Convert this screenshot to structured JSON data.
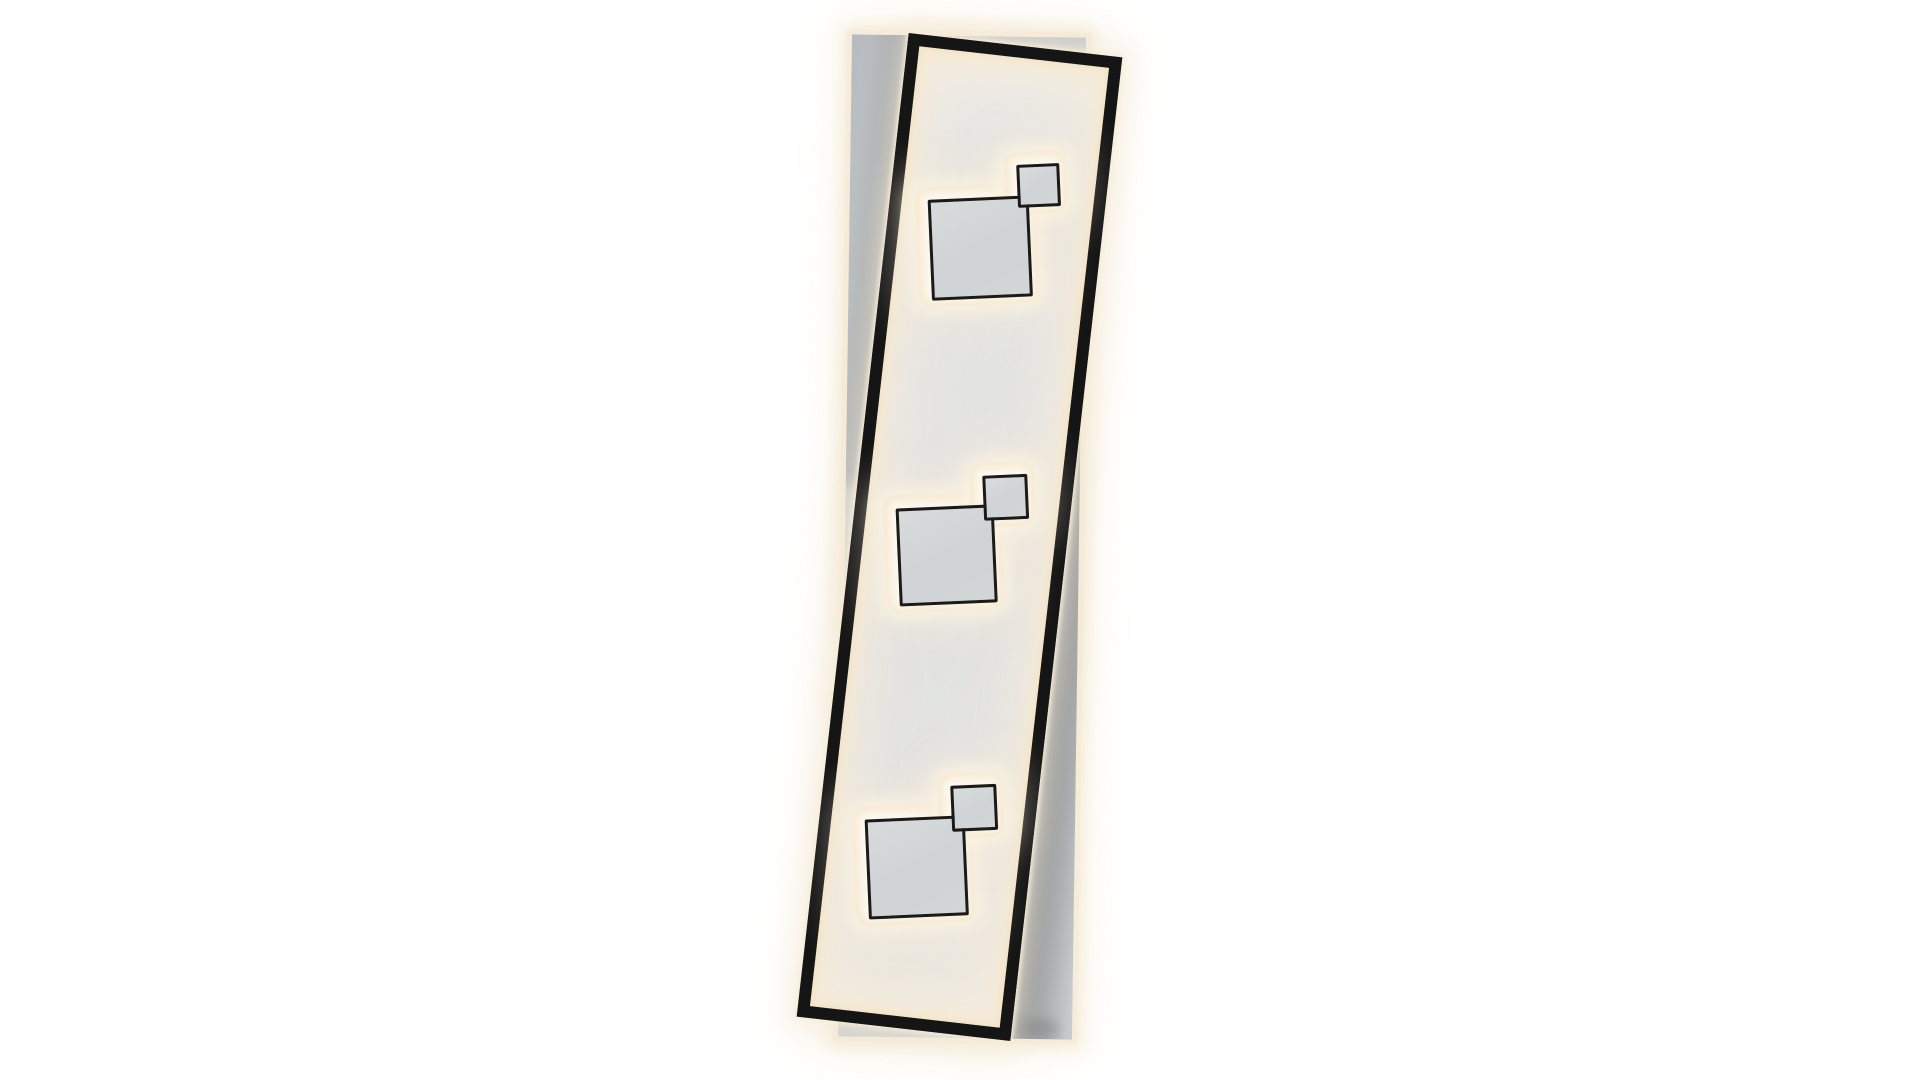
{
  "scene": {
    "description": "Product photo of a rectangular LED ceiling light: a slim black metal frame, tilted clockwise, with warm-white backlit interior, mounted over a straight gray back panel; three pairs of overlapping gray squares (one large, one small) with thin black outlines glow with warm halos along the frame's vertical axis.",
    "background_label": "white studio wall",
    "colors": {
      "wall": "#ffffff",
      "frame_black": "#151515",
      "border_black": "#1a1a1a",
      "panel_gray": "#e2e3e2",
      "gray_dark": "#b7bcc1",
      "gray_mid": "#c3c8cb",
      "gray_light": "#c9cdd0",
      "halo_white": "#fdf8ee",
      "glow_strong": "#f3e3c6",
      "glow_soft": "#f6e9cf",
      "rim_cream": "#f6ecd9",
      "shadow_dark": "rgba(44,49,54,0.55)"
    },
    "back_panel": {
      "left": 845,
      "top": 36,
      "width": 234,
      "height": 1002,
      "rotation_deg": 0.8
    },
    "back_panel_shadows": [
      {
        "name": "right-of-frame",
        "left": 200,
        "top": 378,
        "width": 92,
        "height": 660,
        "rotation_deg": 5.7
      },
      {
        "name": "left-of-frame",
        "left": -20,
        "top": -40,
        "width": 62,
        "height": 490,
        "rotation_deg": 5.7
      },
      {
        "name": "below-frame",
        "left": -45,
        "top": 972,
        "width": 265,
        "height": 34,
        "rotation_deg": 5.7
      }
    ],
    "frame": {
      "left": 852,
      "top": 42,
      "width": 215,
      "height": 990,
      "border_px": 12,
      "rotation_deg": 6.5
    },
    "square_groups": [
      {
        "name": "top",
        "left": 908,
        "top": 145,
        "width": 170,
        "height": 170,
        "rotation_deg": -2.5,
        "halo_big": {
          "left": 10,
          "top": 41,
          "size": 117
        },
        "halo_small": {
          "left": 100,
          "top": 10,
          "size": 59
        },
        "square_big": {
          "left": 21,
          "top": 52,
          "size": 95
        },
        "square_small": {
          "left": 111,
          "top": 21,
          "size": 37
        }
      },
      {
        "name": "middle",
        "left": 876,
        "top": 455,
        "width": 160,
        "height": 170,
        "rotation_deg": -2.5,
        "halo_big": {
          "left": 10,
          "top": 40,
          "size": 114
        },
        "halo_small": {
          "left": 98,
          "top": 11,
          "size": 61
        },
        "square_big": {
          "left": 21,
          "top": 51,
          "size": 92
        },
        "square_small": {
          "left": 109,
          "top": 22,
          "size": 39
        }
      },
      {
        "name": "bottom",
        "left": 845,
        "top": 765,
        "width": 160,
        "height": 170,
        "rotation_deg": -2.5,
        "halo_big": {
          "left": 10,
          "top": 41,
          "size": 116
        },
        "halo_small": {
          "left": 97,
          "top": 11,
          "size": 62
        },
        "square_big": {
          "left": 21,
          "top": 52,
          "size": 94
        },
        "square_small": {
          "left": 108,
          "top": 22,
          "size": 40
        }
      }
    ]
  }
}
